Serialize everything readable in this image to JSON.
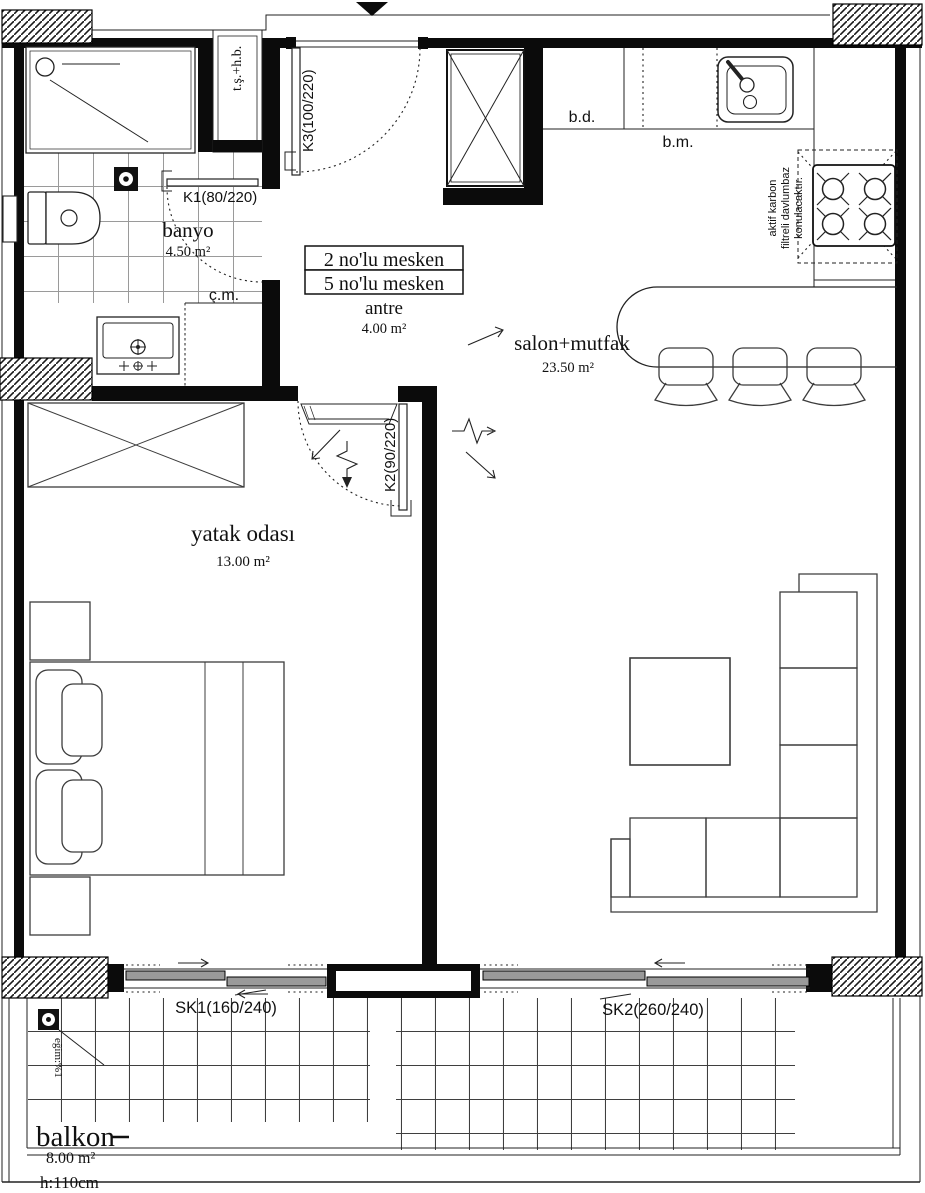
{
  "rooms": {
    "banyo": {
      "name": "banyo",
      "area": "4.50 m²"
    },
    "antre": {
      "name": "antre",
      "area": "4.00 m²"
    },
    "salon": {
      "name": "salon+mutfak",
      "area": "23.50 m²"
    },
    "yatak": {
      "name": "yatak odası",
      "area": "13.00 m²"
    },
    "balkon": {
      "name": "balkon",
      "area": "8.00 m²",
      "parapet_height": "h:110cm"
    }
  },
  "unit_labels": [
    "2 no'lu mesken",
    "5 no'lu mesken"
  ],
  "doors": {
    "k1": "K1(80/220)",
    "k2": "K2(90/220)",
    "k3": "K3(100/220)"
  },
  "windows": {
    "sk1": "SK1(160/240)",
    "sk2": "SK2(260/240)"
  },
  "fixtures": {
    "bd": "b.d.",
    "bm": "b.m.",
    "cm": "ç.m.",
    "tshb": "t.ş.+h.b."
  },
  "notes": {
    "hood_lines": [
      "aktif karbon",
      "filtreli davlumbaz",
      "konulacaktır."
    ],
    "slope": "eğim:%1"
  },
  "colors": {
    "line": "#111111",
    "wall": "#0b0b0b",
    "panel_fill": "#9a9a9a",
    "background": "#ffffff"
  }
}
